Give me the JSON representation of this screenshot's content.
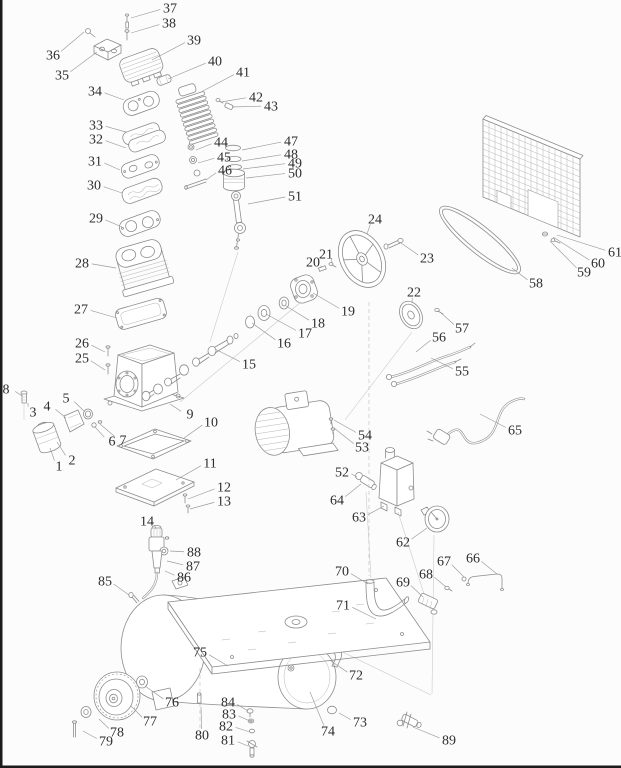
{
  "diagram": {
    "kind": "exploded-parts-diagram",
    "part_count": 89
  },
  "style": {
    "background": "#fcfcfc",
    "line": "#8c8c8c",
    "light_line": "#b5b5b5",
    "label": "#2d2d2d",
    "leader": "#9a9a9a",
    "edge_bar": "#1c1c1c"
  },
  "parts": [
    {
      "n": "1",
      "x": 59,
      "y": 466,
      "tx": 50,
      "ty": 448
    },
    {
      "n": "2",
      "x": 72,
      "y": 460,
      "tx": 57,
      "ty": 442
    },
    {
      "n": "3",
      "x": 33,
      "y": 412,
      "tx": 28,
      "ty": 403
    },
    {
      "n": "4",
      "x": 47,
      "y": 406,
      "tx": 66,
      "ty": 418
    },
    {
      "n": "5",
      "x": 66,
      "y": 398,
      "tx": 84,
      "ty": 411
    },
    {
      "n": "6",
      "x": 112,
      "y": 441,
      "tx": 95,
      "ty": 427
    },
    {
      "n": "7",
      "x": 123,
      "y": 440,
      "tx": 100,
      "ty": 424
    },
    {
      "n": "8",
      "x": 6,
      "y": 389,
      "tx": 22,
      "ty": 396
    },
    {
      "n": "9",
      "x": 190,
      "y": 414,
      "tx": 170,
      "ty": 404
    },
    {
      "n": "10",
      "x": 211,
      "y": 422,
      "tx": 184,
      "ty": 438
    },
    {
      "n": "11",
      "x": 210,
      "y": 463,
      "tx": 176,
      "ty": 480
    },
    {
      "n": "12",
      "x": 224,
      "y": 487,
      "tx": 188,
      "ty": 499
    },
    {
      "n": "13",
      "x": 224,
      "y": 501,
      "tx": 190,
      "ty": 509
    },
    {
      "n": "14",
      "x": 147,
      "y": 521,
      "tx": 156,
      "ty": 529
    },
    {
      "n": "15",
      "x": 249,
      "y": 364,
      "tx": 215,
      "ty": 349
    },
    {
      "n": "16",
      "x": 284,
      "y": 343,
      "tx": 252,
      "ty": 323
    },
    {
      "n": "17",
      "x": 305,
      "y": 333,
      "tx": 266,
      "ty": 314
    },
    {
      "n": "18",
      "x": 318,
      "y": 323,
      "tx": 286,
      "ty": 306
    },
    {
      "n": "19",
      "x": 348,
      "y": 311,
      "tx": 313,
      "ty": 293
    },
    {
      "n": "20",
      "x": 313,
      "y": 262,
      "tx": 321,
      "ty": 268
    },
    {
      "n": "21",
      "x": 326,
      "y": 254,
      "tx": 332,
      "ty": 263
    },
    {
      "n": "22",
      "x": 414,
      "y": 292,
      "tx": 412,
      "ty": 303
    },
    {
      "n": "23",
      "x": 427,
      "y": 258,
      "tx": 401,
      "ty": 243
    },
    {
      "n": "24",
      "x": 375,
      "y": 219,
      "tx": 367,
      "ty": 234
    },
    {
      "n": "25",
      "x": 82,
      "y": 358,
      "tx": 105,
      "ty": 370
    },
    {
      "n": "26",
      "x": 82,
      "y": 343,
      "tx": 105,
      "ty": 352
    },
    {
      "n": "27",
      "x": 81,
      "y": 309,
      "tx": 117,
      "ty": 318
    },
    {
      "n": "28",
      "x": 82,
      "y": 263,
      "tx": 116,
      "ty": 268
    },
    {
      "n": "29",
      "x": 96,
      "y": 218,
      "tx": 122,
      "ty": 227
    },
    {
      "n": "30",
      "x": 94,
      "y": 185,
      "tx": 122,
      "ty": 193
    },
    {
      "n": "31",
      "x": 95,
      "y": 161,
      "tx": 120,
      "ty": 170
    },
    {
      "n": "32",
      "x": 96,
      "y": 139,
      "tx": 126,
      "ty": 148
    },
    {
      "n": "33",
      "x": 96,
      "y": 125,
      "tx": 126,
      "ty": 132
    },
    {
      "n": "34",
      "x": 95,
      "y": 91,
      "tx": 124,
      "ty": 100
    },
    {
      "n": "35",
      "x": 62,
      "y": 75,
      "tx": 97,
      "ty": 52
    },
    {
      "n": "36",
      "x": 53,
      "y": 55,
      "tx": 84,
      "ty": 32
    },
    {
      "n": "37",
      "x": 170,
      "y": 8,
      "tx": 131,
      "ty": 18
    },
    {
      "n": "38",
      "x": 169,
      "y": 23,
      "tx": 131,
      "ty": 33
    },
    {
      "n": "39",
      "x": 194,
      "y": 40,
      "tx": 152,
      "ty": 60
    },
    {
      "n": "40",
      "x": 215,
      "y": 61,
      "tx": 168,
      "ty": 79
    },
    {
      "n": "41",
      "x": 243,
      "y": 72,
      "tx": 201,
      "ty": 92
    },
    {
      "n": "42",
      "x": 256,
      "y": 97,
      "tx": 221,
      "ty": 102
    },
    {
      "n": "43",
      "x": 271,
      "y": 106,
      "tx": 232,
      "ty": 107
    },
    {
      "n": "44",
      "x": 221,
      "y": 142,
      "tx": 196,
      "ty": 150
    },
    {
      "n": "45",
      "x": 224,
      "y": 157,
      "tx": 198,
      "ty": 163
    },
    {
      "n": "46",
      "x": 225,
      "y": 170,
      "tx": 206,
      "ty": 180
    },
    {
      "n": "47",
      "x": 291,
      "y": 141,
      "tx": 242,
      "ty": 150
    },
    {
      "n": "48",
      "x": 291,
      "y": 154,
      "tx": 242,
      "ty": 161
    },
    {
      "n": "49",
      "x": 295,
      "y": 163,
      "tx": 243,
      "ty": 169
    },
    {
      "n": "50",
      "x": 295,
      "y": 173,
      "tx": 246,
      "ty": 178
    },
    {
      "n": "51",
      "x": 295,
      "y": 196,
      "tx": 248,
      "ty": 204
    },
    {
      "n": "52",
      "x": 342,
      "y": 472,
      "tx": 357,
      "ty": 477
    },
    {
      "n": "53",
      "x": 362,
      "y": 447,
      "tx": 334,
      "ty": 428
    },
    {
      "n": "54",
      "x": 365,
      "y": 435,
      "tx": 334,
      "ty": 420
    },
    {
      "n": "55",
      "x": 462,
      "y": 371,
      "tx": 431,
      "ty": 358
    },
    {
      "n": "56",
      "x": 439,
      "y": 337,
      "tx": 416,
      "ty": 352
    },
    {
      "n": "57",
      "x": 462,
      "y": 328,
      "tx": 440,
      "ty": 312
    },
    {
      "n": "58",
      "x": 536,
      "y": 283,
      "tx": 512,
      "ty": 268
    },
    {
      "n": "59",
      "x": 584,
      "y": 272,
      "tx": 550,
      "ty": 241
    },
    {
      "n": "60",
      "x": 598,
      "y": 263,
      "tx": 553,
      "ty": 237
    },
    {
      "n": "61",
      "x": 615,
      "y": 252,
      "tx": 557,
      "ty": 235
    },
    {
      "n": "62",
      "x": 403,
      "y": 542,
      "tx": 427,
      "ty": 528
    },
    {
      "n": "63",
      "x": 359,
      "y": 517,
      "tx": 384,
      "ty": 506
    },
    {
      "n": "64",
      "x": 337,
      "y": 500,
      "tx": 361,
      "ty": 484
    },
    {
      "n": "65",
      "x": 515,
      "y": 430,
      "tx": 480,
      "ty": 414
    },
    {
      "n": "66",
      "x": 473,
      "y": 558,
      "tx": 497,
      "ty": 574
    },
    {
      "n": "67",
      "x": 444,
      "y": 561,
      "tx": 464,
      "ty": 577
    },
    {
      "n": "68",
      "x": 426,
      "y": 574,
      "tx": 446,
      "ty": 587
    },
    {
      "n": "69",
      "x": 403,
      "y": 582,
      "tx": 423,
      "ty": 597
    },
    {
      "n": "70",
      "x": 342,
      "y": 571,
      "tx": 368,
      "ty": 584
    },
    {
      "n": "71",
      "x": 343,
      "y": 605,
      "tx": 376,
      "ty": 619
    },
    {
      "n": "72",
      "x": 356,
      "y": 675,
      "tx": 331,
      "ty": 661
    },
    {
      "n": "73",
      "x": 360,
      "y": 722,
      "tx": 339,
      "ty": 713
    },
    {
      "n": "74",
      "x": 328,
      "y": 731,
      "tx": 310,
      "ty": 692
    },
    {
      "n": "75",
      "x": 200,
      "y": 652,
      "tx": 228,
      "ty": 666
    },
    {
      "n": "76",
      "x": 172,
      "y": 702,
      "tx": 145,
      "ty": 686
    },
    {
      "n": "77",
      "x": 150,
      "y": 721,
      "tx": 131,
      "ty": 706
    },
    {
      "n": "78",
      "x": 117,
      "y": 732,
      "tx": 99,
      "ty": 719
    },
    {
      "n": "79",
      "x": 106,
      "y": 741,
      "tx": 83,
      "ty": 731
    },
    {
      "n": "80",
      "x": 202,
      "y": 735,
      "tx": 201,
      "ty": 707
    },
    {
      "n": "81",
      "x": 228,
      "y": 740,
      "tx": 248,
      "ty": 746
    },
    {
      "n": "82",
      "x": 226,
      "y": 726,
      "tx": 250,
      "ty": 732
    },
    {
      "n": "83",
      "x": 229,
      "y": 714,
      "tx": 250,
      "ty": 721
    },
    {
      "n": "84",
      "x": 228,
      "y": 702,
      "tx": 248,
      "ty": 711
    },
    {
      "n": "85",
      "x": 105,
      "y": 581,
      "tx": 129,
      "ty": 595
    },
    {
      "n": "86",
      "x": 184,
      "y": 577,
      "tx": 165,
      "ty": 571
    },
    {
      "n": "87",
      "x": 193,
      "y": 566,
      "tx": 167,
      "ty": 561
    },
    {
      "n": "88",
      "x": 194,
      "y": 552,
      "tx": 170,
      "ty": 551
    },
    {
      "n": "89",
      "x": 449,
      "y": 740,
      "tx": 413,
      "ty": 727
    }
  ]
}
